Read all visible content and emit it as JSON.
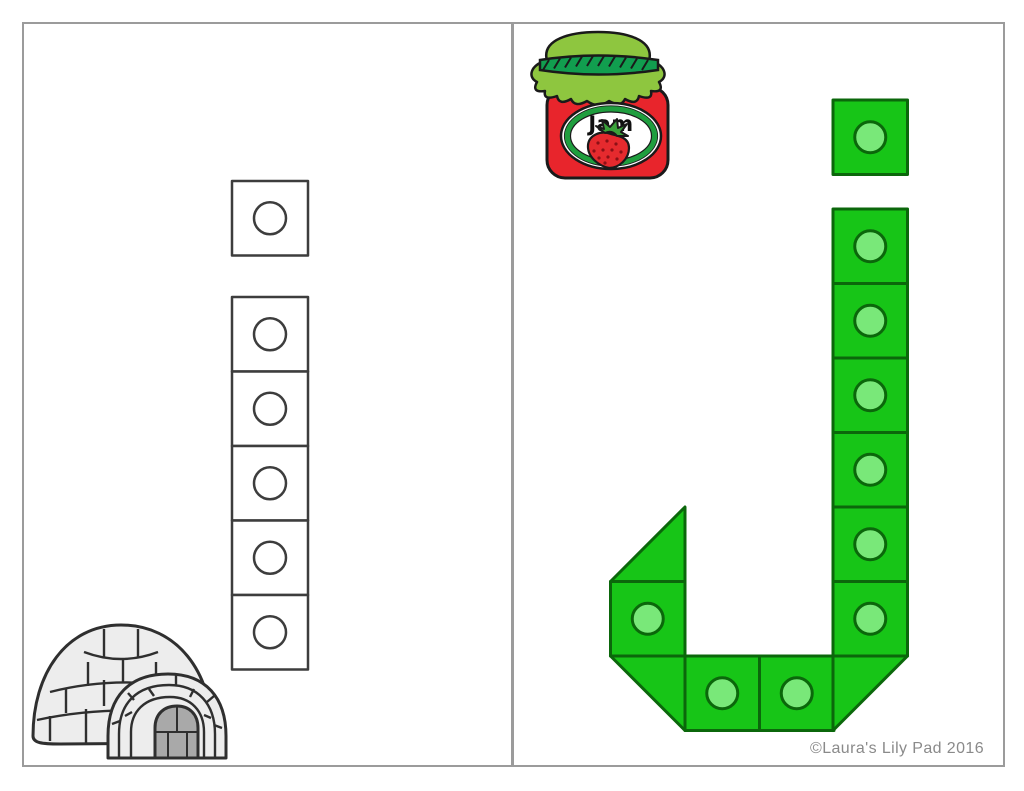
{
  "worksheet": {
    "credit": "©Laura's Lily Pad 2016",
    "colors": {
      "page_border": "#9b9b9b",
      "white_cube_outline": "#3d3d3d",
      "green_cube_fill": "#17c517",
      "green_cube_outline": "#0b670b",
      "green_dot_fill": "#79e879",
      "jar_red": "#e8252c",
      "lid_light_green": "#8ec63f",
      "rope_dark_green": "#119e4f",
      "credit_gray": "#8a8a8a"
    }
  },
  "page_left": {
    "letter": "i",
    "icon": "igloo",
    "cube_fill": "#ffffff",
    "cube_stroke": "#3d3d3d",
    "dot_fill": "#ffffff",
    "dot_stroke": "#3d3d3d",
    "stroke_width": 2.5,
    "cube_w": 76,
    "cube_h": 74.5,
    "dot_r": 16,
    "pieces": [
      {
        "type": "square",
        "x": 232,
        "y": 181
      },
      {
        "type": "square",
        "x": 232,
        "y": 297
      },
      {
        "type": "square",
        "x": 232,
        "y": 371.5
      },
      {
        "type": "square",
        "x": 232,
        "y": 446
      },
      {
        "type": "square",
        "x": 232,
        "y": 520.5
      },
      {
        "type": "square",
        "x": 232,
        "y": 595
      }
    ]
  },
  "page_right": {
    "letter": "j",
    "icon": "jam-jar",
    "jar_label": "Jam",
    "credit": "©Laura's Lily Pad 2016",
    "cube_fill": "#17c517",
    "cube_stroke": "#0b670b",
    "dot_fill": "#79e879",
    "dot_stroke": "#0b670b",
    "stroke_width": 3,
    "cube_w": 74.5,
    "cube_h": 74.5,
    "dot_r": 15.5,
    "pieces": [
      {
        "type": "square",
        "x": 833,
        "y": 100
      },
      {
        "type": "square",
        "x": 833,
        "y": 209
      },
      {
        "type": "square",
        "x": 833,
        "y": 283.5
      },
      {
        "type": "square",
        "x": 833,
        "y": 358
      },
      {
        "type": "square",
        "x": 833,
        "y": 432.5
      },
      {
        "type": "square",
        "x": 833,
        "y": 507
      },
      {
        "type": "square",
        "x": 833,
        "y": 581.5
      },
      {
        "type": "triangle",
        "points": "685,507 685,581.5 610.5,581.5"
      },
      {
        "type": "square",
        "x": 610.5,
        "y": 581.5
      },
      {
        "type": "triangle",
        "points": "610.5,656 685,656 685,730.5"
      },
      {
        "type": "square",
        "x": 685,
        "y": 656
      },
      {
        "type": "square",
        "x": 759.5,
        "y": 656
      },
      {
        "type": "triangle",
        "points": "833,656 907.5,656 833,730.5"
      }
    ]
  }
}
